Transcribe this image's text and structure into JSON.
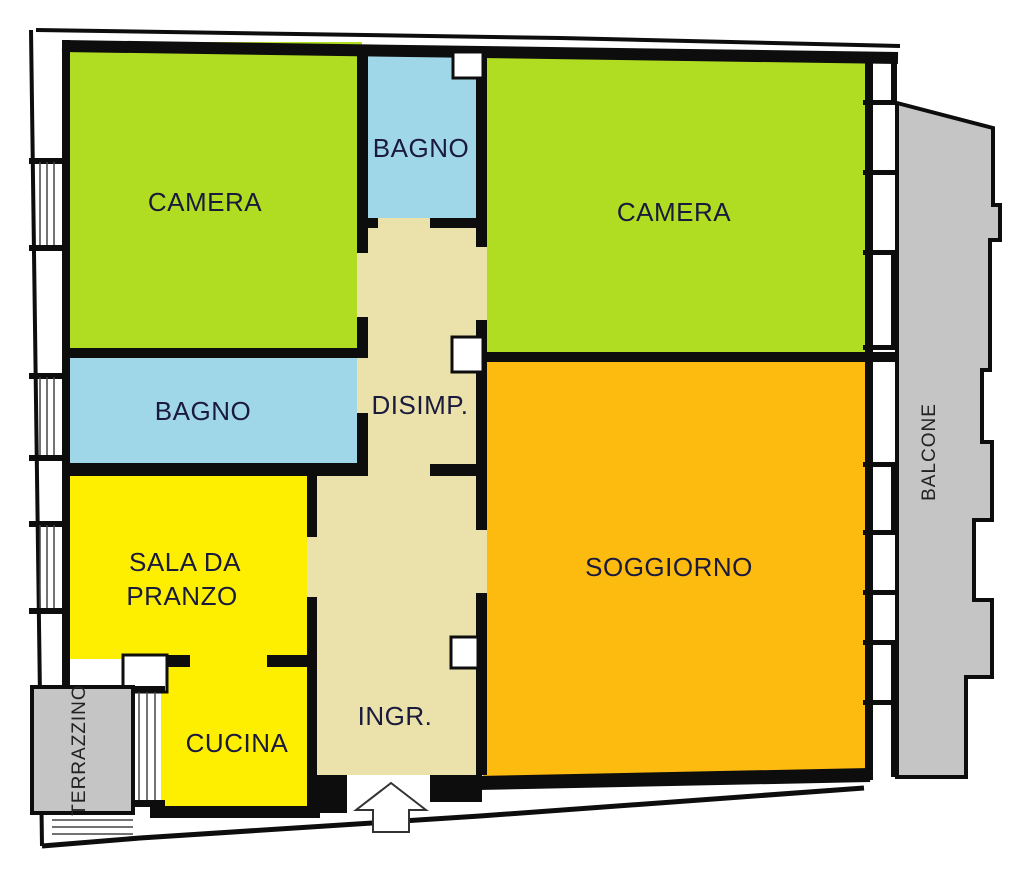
{
  "colors": {
    "bedroom_green": "#B0DD21",
    "bath_blue": "#A0D7E8",
    "hall_beige": "#EBE2AB",
    "dining_yellow": "#FEEF00",
    "living_orange": "#FDBB10",
    "outdoor_gray": "#C5C5C5",
    "wall_black": "#0D0D0D",
    "label_dark": "#1A1A3C",
    "outdoor_label": "#222222"
  },
  "plan": {
    "rooms": {
      "camera_1": "CAMERA",
      "bagno_1": "BAGNO",
      "camera_2": "CAMERA",
      "bagno_2": "BAGNO",
      "disimpegno": "DISIMP.",
      "sala_da_pranzo_line1": "SALA DA",
      "sala_da_pranzo_line2": "PRANZO",
      "soggiorno": "SOGGIORNO",
      "cucina": "CUCINA",
      "ingresso": "INGR.",
      "balcone": "BALCONE",
      "terrazzino": "TERRAZZINO"
    }
  }
}
